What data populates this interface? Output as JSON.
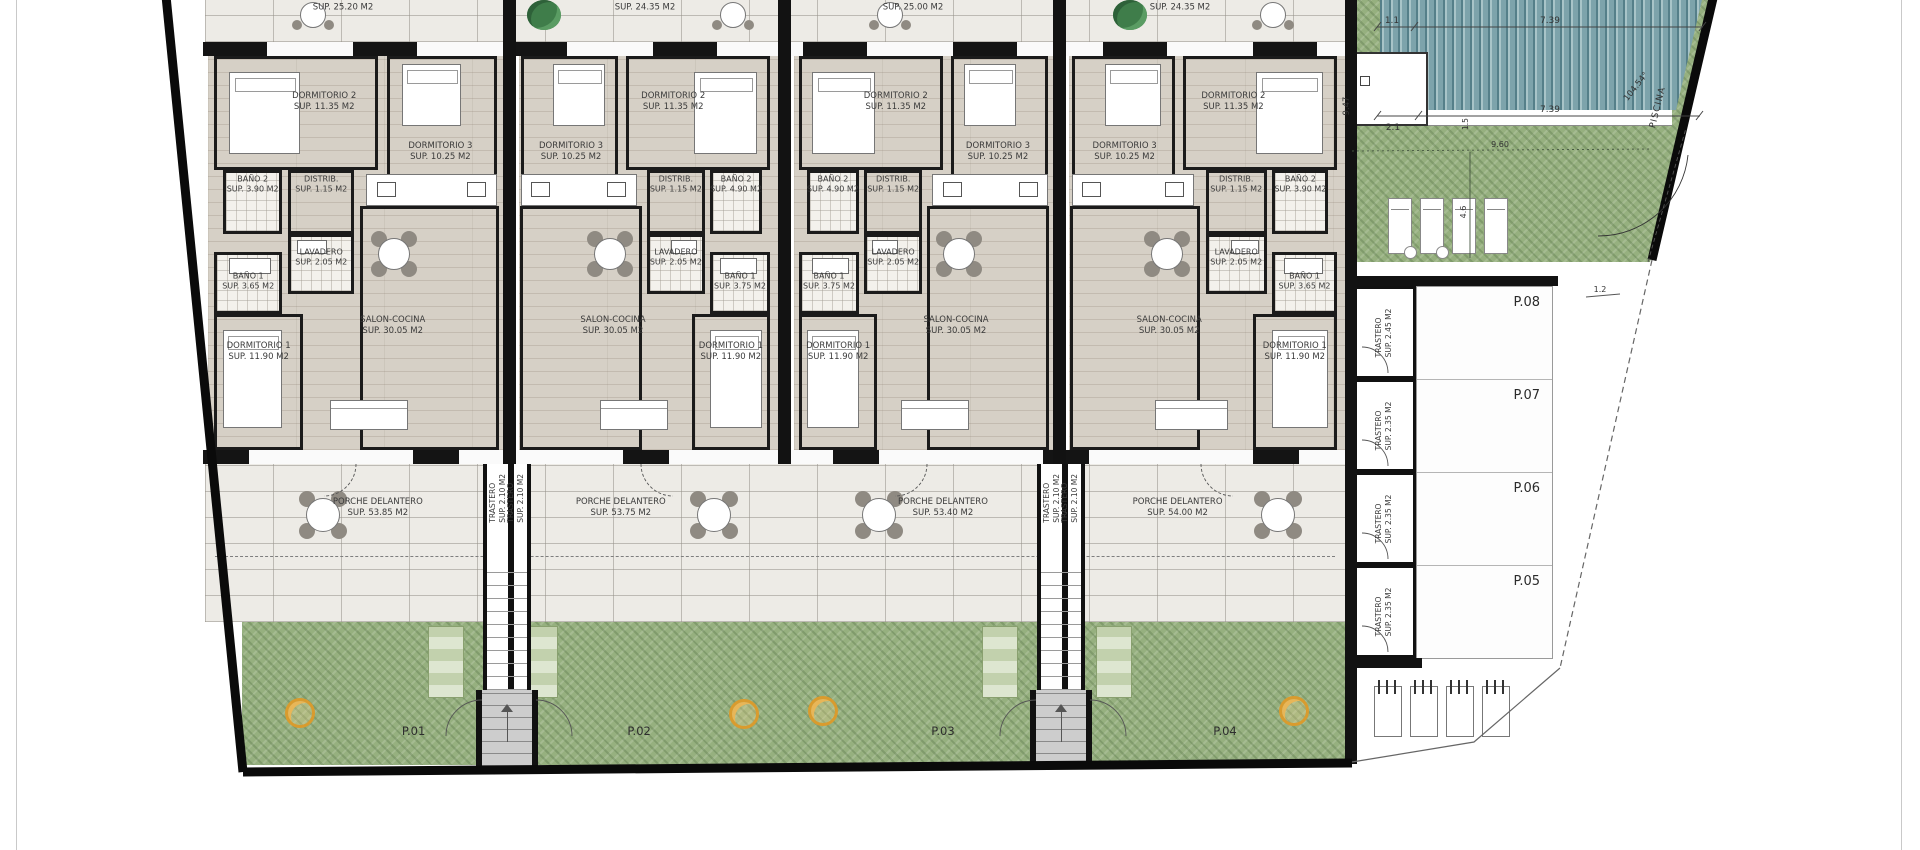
{
  "colors": {
    "wood": "#d6d0c6",
    "tile": "#edebe6",
    "garden_green": "#96b07f",
    "pool_teal": "#7da3ab",
    "wall_black": "#121212",
    "tree_orange": "#d99b2e"
  },
  "rear_porches": [
    {
      "sup": "SUP. 25.20 M2"
    },
    {
      "sup": "SUP. 24.35 M2"
    },
    {
      "sup": "SUP. 25.00 M2"
    },
    {
      "sup": "SUP. 24.35 M2"
    }
  ],
  "units": [
    {
      "plot": "P.01",
      "porch": {
        "name": "PORCHE DELANTERO",
        "sup": "SUP. 53.85 M2"
      },
      "rooms": {
        "dorm2": {
          "name": "DORMITORIO 2",
          "sup": "SUP. 11.35 M2"
        },
        "dorm3": {
          "name": "DORMITORIO 3",
          "sup": "SUP. 10.25 M2"
        },
        "bano2": {
          "name": "BAÑO 2",
          "sup": "SUP. 3.90 M2"
        },
        "distrib": {
          "name": "DISTRIB.",
          "sup": "SUP. 1.15 M2"
        },
        "lavadero": {
          "name": "LAVADERO",
          "sup": "SUP. 2.05 M2"
        },
        "bano1": {
          "name": "BAÑO 1",
          "sup": "SUP. 3.65 M2"
        },
        "dorm1": {
          "name": "DORMITORIO 1",
          "sup": "SUP. 11.90 M2"
        },
        "salon": {
          "name": "SALON-COCINA",
          "sup": "SUP. 30.05 M2"
        }
      }
    },
    {
      "plot": "P.02",
      "porch": {
        "name": "PORCHE DELANTERO",
        "sup": "SUP. 53.75 M2"
      },
      "rooms": {
        "dorm2": {
          "name": "DORMITORIO 2",
          "sup": "SUP. 11.35 M2"
        },
        "dorm3": {
          "name": "DORMITORIO 3",
          "sup": "SUP. 10.25 M2"
        },
        "bano2": {
          "name": "BAÑO 2",
          "sup": "SUP. 4.90 M2"
        },
        "distrib": {
          "name": "DISTRIB.",
          "sup": "SUP. 1.15 M2"
        },
        "lavadero": {
          "name": "LAVADERO",
          "sup": "SUP. 2.05 M2"
        },
        "bano1": {
          "name": "BAÑO 1",
          "sup": "SUP. 3.75 M2"
        },
        "dorm1": {
          "name": "DORMITORIO 1",
          "sup": "SUP. 11.90 M2"
        },
        "salon": {
          "name": "SALON-COCINA",
          "sup": "SUP. 30.05 M2"
        }
      }
    },
    {
      "plot": "P.03",
      "porch": {
        "name": "PORCHE DELANTERO",
        "sup": "SUP. 53.40 M2"
      },
      "rooms": {
        "dorm2": {
          "name": "DORMITORIO 2",
          "sup": "SUP. 11.35 M2"
        },
        "dorm3": {
          "name": "DORMITORIO 3",
          "sup": "SUP. 10.25 M2"
        },
        "bano2": {
          "name": "BAÑO 2",
          "sup": "SUP. 4.90 M2"
        },
        "distrib": {
          "name": "DISTRIB.",
          "sup": "SUP. 1.15 M2"
        },
        "lavadero": {
          "name": "LAVADERO",
          "sup": "SUP. 2.05 M2"
        },
        "bano1": {
          "name": "BAÑO 1",
          "sup": "SUP. 3.75 M2"
        },
        "dorm1": {
          "name": "DORMITORIO 1",
          "sup": "SUP. 11.90 M2"
        },
        "salon": {
          "name": "SALON-COCINA",
          "sup": "SUP. 30.05 M2"
        }
      }
    },
    {
      "plot": "P.04",
      "porch": {
        "name": "PORCHE DELANTERO",
        "sup": "SUP. 54.00 M2"
      },
      "rooms": {
        "dorm2": {
          "name": "DORMITORIO 2",
          "sup": "SUP. 11.35 M2"
        },
        "dorm3": {
          "name": "DORMITORIO 3",
          "sup": "SUP. 10.25 M2"
        },
        "bano2": {
          "name": "BAÑO 2",
          "sup": "SUP. 3.90 M2"
        },
        "distrib": {
          "name": "DISTRIB.",
          "sup": "SUP. 1.15 M2"
        },
        "lavadero": {
          "name": "LAVADERO",
          "sup": "SUP. 2.05 M2"
        },
        "bano1": {
          "name": "BAÑO 1",
          "sup": "SUP. 3.65 M2"
        },
        "dorm1": {
          "name": "DORMITORIO 1",
          "sup": "SUP. 11.90 M2"
        },
        "salon": {
          "name": "SALON-COCINA",
          "sup": "SUP. 30.05 M2"
        }
      }
    }
  ],
  "stairwells": [
    {
      "left": {
        "name": "TRASTERO",
        "sup": "SUP. 2.10 M2"
      },
      "right": {
        "name": "TRASTERO",
        "sup": "SUP. 2.10 M2"
      }
    },
    {
      "left": {
        "name": "TRASTERO",
        "sup": "SUP. 2.10 M2"
      },
      "right": {
        "name": "TRASTERO",
        "sup": "SUP. 2.10 M2"
      }
    }
  ],
  "right_zone": {
    "pool": {
      "label": "PISCINA",
      "angle": "104.54°"
    },
    "dims": {
      "top_small": "1.1",
      "top_main": "7.39",
      "mid_left": "2.1",
      "mid_main": "7.39",
      "side_v": "9.47",
      "green_w": "9.60",
      "green_h": "4.6",
      "deck_small": "1.5",
      "p08_small": "1.2"
    },
    "parking": [
      {
        "label": "P.08",
        "trastero": {
          "name": "TRASTERO",
          "sup": "SUP. 2.45 M2"
        }
      },
      {
        "label": "P.07",
        "trastero": {
          "name": "TRASTERO",
          "sup": "SUP. 2.35 M2"
        }
      },
      {
        "label": "P.06",
        "trastero": {
          "name": "TRASTERO",
          "sup": "SUP. 2.35 M2"
        }
      },
      {
        "label": "P.05",
        "trastero": {
          "name": "TRASTERO",
          "sup": "SUP. 2.35 M2"
        }
      }
    ]
  }
}
